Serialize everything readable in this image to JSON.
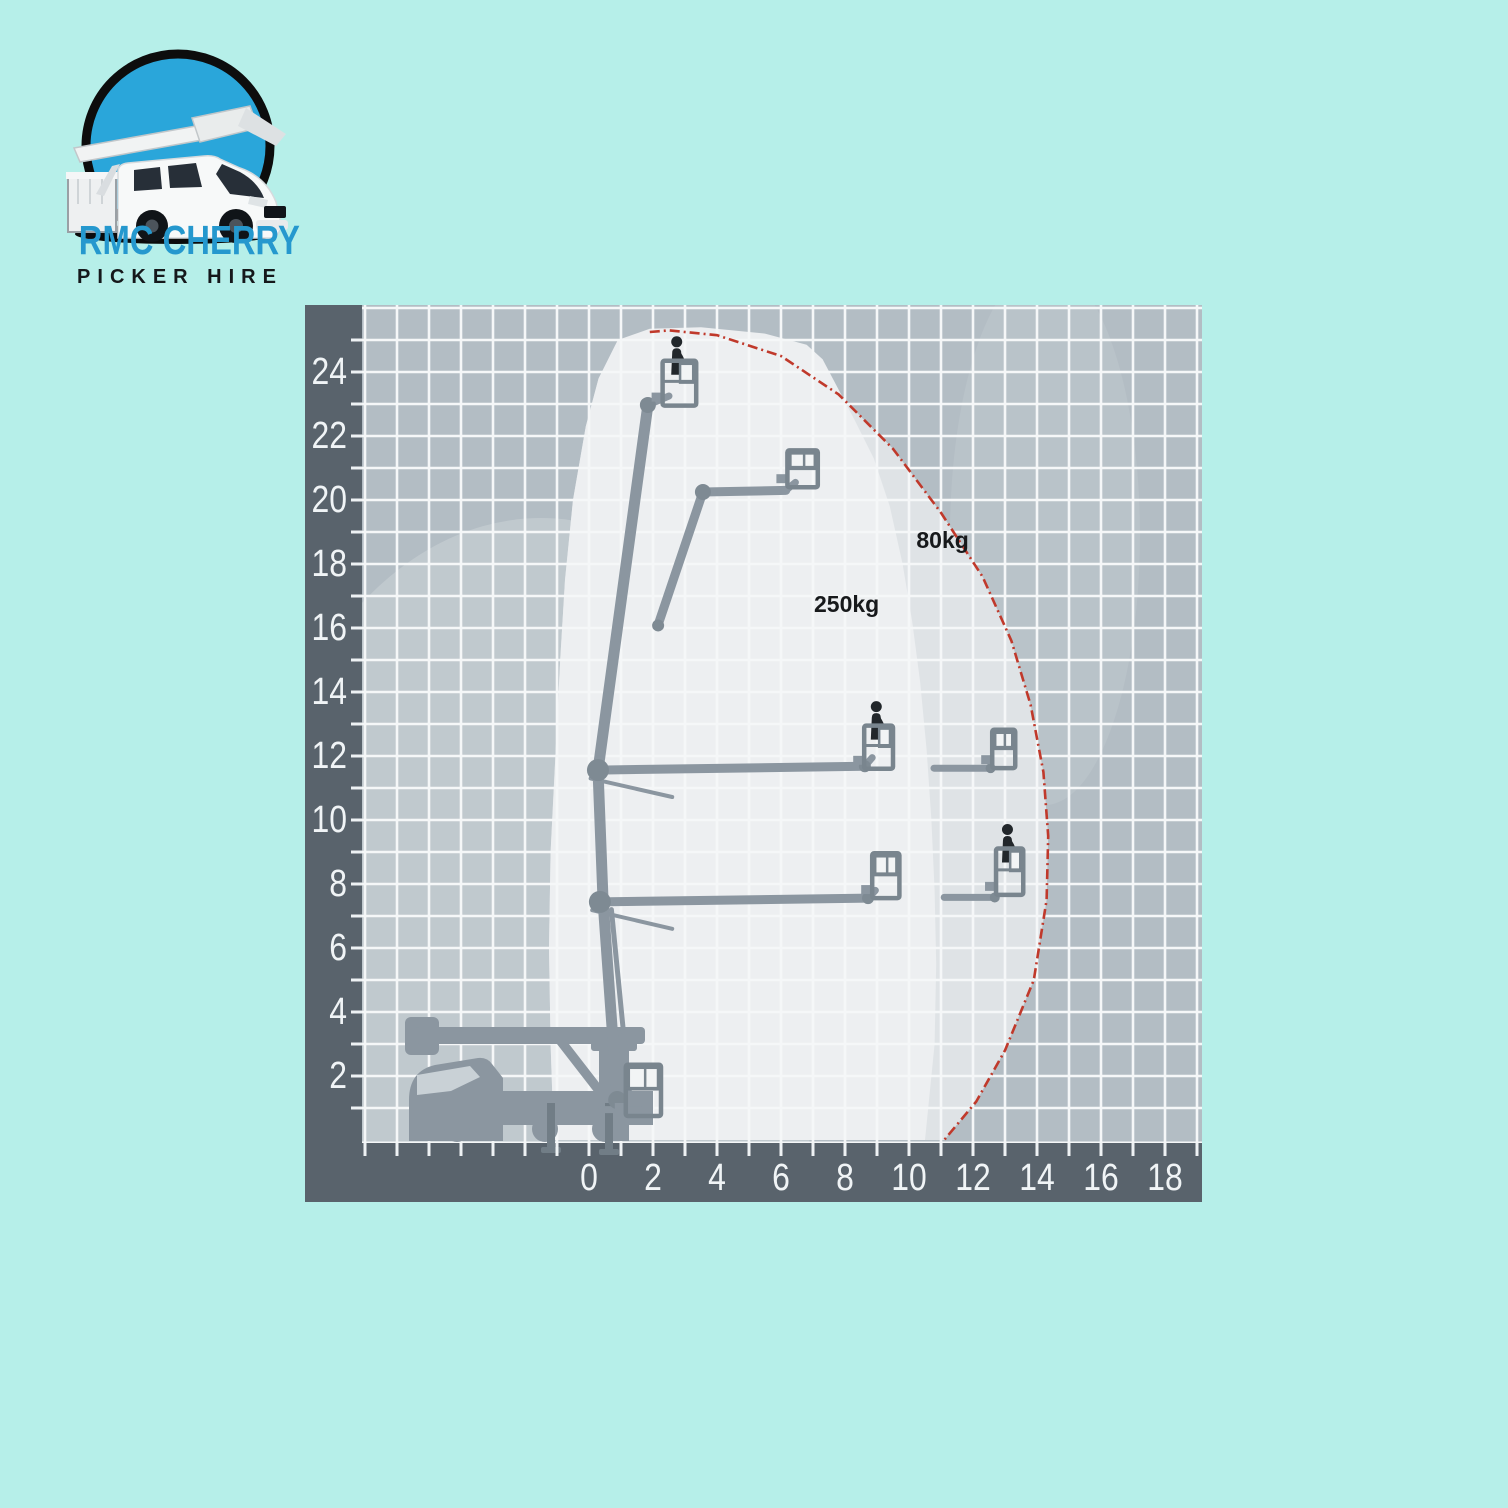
{
  "page": {
    "background": "#b6efe9"
  },
  "logo": {
    "line1": "RMC CHERRY",
    "line2": "PICKER HIRE",
    "title_color": "#2598ce",
    "subtitle_color": "#15181b",
    "circle_blue": "#2aa6da",
    "ring_black": "#0d0d0d"
  },
  "chart_data": {
    "type": "area",
    "title": "",
    "xlabel": "",
    "ylabel": "",
    "grid": true,
    "px_per_unit": 32,
    "origin_px": [
      284,
      835
    ],
    "plot": {
      "left": 57,
      "top": 0,
      "right": 897,
      "bottom": 838,
      "width": 897,
      "height": 897
    },
    "x_axis": {
      "labels": [
        0,
        2,
        4,
        6,
        8,
        10,
        12,
        14,
        16,
        18
      ],
      "tick_from": -7,
      "tick_to": 19
    },
    "y_axis": {
      "labels": [
        2,
        4,
        6,
        8,
        10,
        12,
        14,
        16,
        18,
        20,
        22,
        24
      ],
      "tick_from": 1,
      "tick_to": 26
    },
    "x_range_units": [
      -7.1,
      19.2
    ],
    "y_range_units": [
      0,
      26.2
    ],
    "max_outreach_m": 14.35,
    "max_height_m": 25.4,
    "colors": {
      "band": "#59636c",
      "grid_bg": "#b3bdc4",
      "grid_line": "#f5f7f8",
      "tick": "#eef2f4",
      "axis_label": "#f0f4f6",
      "zone_outer": "#dfe3e6",
      "zone_inner": "#edeff1",
      "red": "#c0392b",
      "machine": "#8b96a0",
      "joint": "#7e8a93",
      "basket": "#79858e",
      "pane": "#f2f4f5",
      "person": "#22272b",
      "label_text": "#17191b"
    },
    "glows": [
      {
        "cx": 236,
        "cy": 643,
        "rx": 300,
        "ry": 430,
        "opacity": 0.18
      },
      {
        "cx": 740,
        "cy": 230,
        "rx": 95,
        "ry": 270,
        "opacity": 0.09
      }
    ],
    "zones": [
      {
        "name": "80kg capacity zone",
        "label": "80kg",
        "label_at": [
          11.05,
          18.5
        ],
        "outline": [
          [
            -1.1,
            0
          ],
          [
            -1.2,
            3
          ],
          [
            -1.25,
            6
          ],
          [
            -1.2,
            9
          ],
          [
            -1.05,
            12
          ],
          [
            -0.9,
            15
          ],
          [
            -0.75,
            17.5
          ],
          [
            -0.5,
            20
          ],
          [
            -0.1,
            22.3
          ],
          [
            0.3,
            23.8
          ],
          [
            0.9,
            24.9
          ],
          [
            1.9,
            25.25
          ],
          [
            2.5,
            25.3
          ],
          [
            4.0,
            25.15
          ],
          [
            6.0,
            24.5
          ],
          [
            7.8,
            23.3
          ],
          [
            9.5,
            21.6
          ],
          [
            11.0,
            19.6
          ],
          [
            12.3,
            17.6
          ],
          [
            13.2,
            15.6
          ],
          [
            13.8,
            13.6
          ],
          [
            14.2,
            11.5
          ],
          [
            14.35,
            9.5
          ],
          [
            14.3,
            7.5
          ],
          [
            13.9,
            5.0
          ],
          [
            13.0,
            2.8
          ],
          [
            12.1,
            1.2
          ],
          [
            11.1,
            0
          ]
        ],
        "red_boundary": [
          [
            1.9,
            25.25
          ],
          [
            2.5,
            25.3
          ],
          [
            4.0,
            25.15
          ],
          [
            6.0,
            24.5
          ],
          [
            7.8,
            23.3
          ],
          [
            9.5,
            21.6
          ],
          [
            11.0,
            19.6
          ],
          [
            12.3,
            17.6
          ],
          [
            13.2,
            15.6
          ],
          [
            13.8,
            13.6
          ],
          [
            14.2,
            11.5
          ],
          [
            14.35,
            9.5
          ],
          [
            14.3,
            7.5
          ],
          [
            13.9,
            5.0
          ],
          [
            13.0,
            2.8
          ],
          [
            12.1,
            1.2
          ],
          [
            11.1,
            0
          ]
        ]
      },
      {
        "name": "250kg capacity zone",
        "label": "250kg",
        "label_at": [
          8.05,
          16.5
        ],
        "outline": [
          [
            -1.1,
            0
          ],
          [
            -1.2,
            3
          ],
          [
            -1.25,
            6
          ],
          [
            -1.2,
            9
          ],
          [
            -1.05,
            12
          ],
          [
            -0.9,
            15
          ],
          [
            -0.75,
            17.5
          ],
          [
            -0.5,
            20
          ],
          [
            -0.1,
            22.3
          ],
          [
            0.3,
            23.8
          ],
          [
            0.9,
            25.0
          ],
          [
            1.9,
            25.35
          ],
          [
            3.5,
            25.4
          ],
          [
            5.5,
            25.2
          ],
          [
            6.8,
            24.85
          ],
          [
            7.3,
            24.4
          ],
          [
            8.3,
            22.5
          ],
          [
            8.9,
            21.3
          ],
          [
            9.4,
            19.8
          ],
          [
            9.8,
            18.0
          ],
          [
            10.1,
            16.2
          ],
          [
            10.35,
            14.3
          ],
          [
            10.55,
            12.2
          ],
          [
            10.7,
            10.0
          ],
          [
            10.8,
            7.8
          ],
          [
            10.85,
            5.5
          ],
          [
            10.8,
            3.0
          ],
          [
            10.6,
            1.0
          ],
          [
            10.5,
            0
          ]
        ]
      }
    ],
    "machine": {
      "booms": [
        {
          "pts": [
            [
              0.88,
              1.25
            ],
            [
              0.44,
              7.44
            ],
            [
              0.28,
              11.56
            ],
            [
              1.84,
              22.97
            ]
          ],
          "w": 11
        },
        {
          "pts": [
            [
              1.3,
              1.1
            ],
            [
              0.7,
              7.2
            ]
          ],
          "w": 5
        },
        {
          "pts": [
            [
              0.4,
              0.95
            ],
            [
              1.6,
              0.95
            ]
          ],
          "w": 7
        },
        {
          "pts": [
            [
              0.28,
              11.56
            ],
            [
              8.62,
              11.68
            ]
          ],
          "w": 9
        },
        {
          "pts": [
            [
              8.62,
              11.68
            ],
            [
              8.85,
              11.95
            ]
          ],
          "w": 7
        },
        {
          "pts": [
            [
              0.05,
              11.3
            ],
            [
              2.6,
              10.72
            ]
          ],
          "w": 4
        },
        {
          "pts": [
            [
              0.34,
              7.44
            ],
            [
              8.72,
              7.56
            ]
          ],
          "w": 9
        },
        {
          "pts": [
            [
              8.72,
              7.56
            ],
            [
              8.95,
              7.8
            ]
          ],
          "w": 7
        },
        {
          "pts": [
            [
              0.1,
              7.18
            ],
            [
              2.6,
              6.6
            ]
          ],
          "w": 4
        },
        {
          "pts": [
            [
              2.16,
              16.1
            ],
            [
              3.56,
              20.25
            ]
          ],
          "w": 9
        },
        {
          "pts": [
            [
              3.56,
              20.25
            ],
            [
              6.15,
              20.3
            ]
          ],
          "w": 9
        },
        {
          "pts": [
            [
              6.15,
              20.3
            ],
            [
              6.45,
              20.55
            ]
          ],
          "w": 7
        },
        {
          "pts": [
            [
              1.84,
              22.97
            ],
            [
              2.5,
              23.25
            ]
          ],
          "w": 7
        },
        {
          "pts": [
            [
              10.78,
              11.62
            ],
            [
              12.55,
              11.62
            ]
          ],
          "w": 7
        },
        {
          "pts": [
            [
              11.1,
              7.58
            ],
            [
              12.68,
              7.58
            ]
          ],
          "w": 7
        }
      ],
      "joints": [
        {
          "x": 0.28,
          "y": 11.56,
          "r": 11
        },
        {
          "x": 0.34,
          "y": 7.44,
          "r": 11
        },
        {
          "x": 1.84,
          "y": 22.97,
          "r": 8
        },
        {
          "x": 3.56,
          "y": 20.25,
          "r": 8
        },
        {
          "x": 2.16,
          "y": 16.08,
          "r": 6
        },
        {
          "x": 8.62,
          "y": 11.68,
          "r": 6
        },
        {
          "x": 8.72,
          "y": 7.56,
          "r": 6
        },
        {
          "x": 12.55,
          "y": 11.62,
          "r": 5
        },
        {
          "x": 12.68,
          "y": 7.58,
          "r": 5
        },
        {
          "x": 0.88,
          "y": 1.25,
          "r": 9
        }
      ],
      "baskets": [
        {
          "x": 2.3,
          "w": 1.05,
          "bottom": 22.95,
          "h": 1.4,
          "person": true
        },
        {
          "x": 6.2,
          "w": 0.95,
          "bottom": 20.4,
          "h": 1.15,
          "person": false
        },
        {
          "x": 8.6,
          "w": 0.9,
          "bottom": 11.6,
          "h": 1.35,
          "person": true
        },
        {
          "x": 12.6,
          "w": 0.72,
          "bottom": 11.62,
          "h": 1.2,
          "person": false
        },
        {
          "x": 8.85,
          "w": 0.85,
          "bottom": 7.56,
          "h": 1.4,
          "person": false
        },
        {
          "x": 12.72,
          "w": 0.85,
          "bottom": 7.66,
          "h": 1.45,
          "person": true
        },
        {
          "x": 1.15,
          "w": 1.1,
          "bottom": 0.75,
          "h": 1.6,
          "person": false
        }
      ]
    }
  }
}
